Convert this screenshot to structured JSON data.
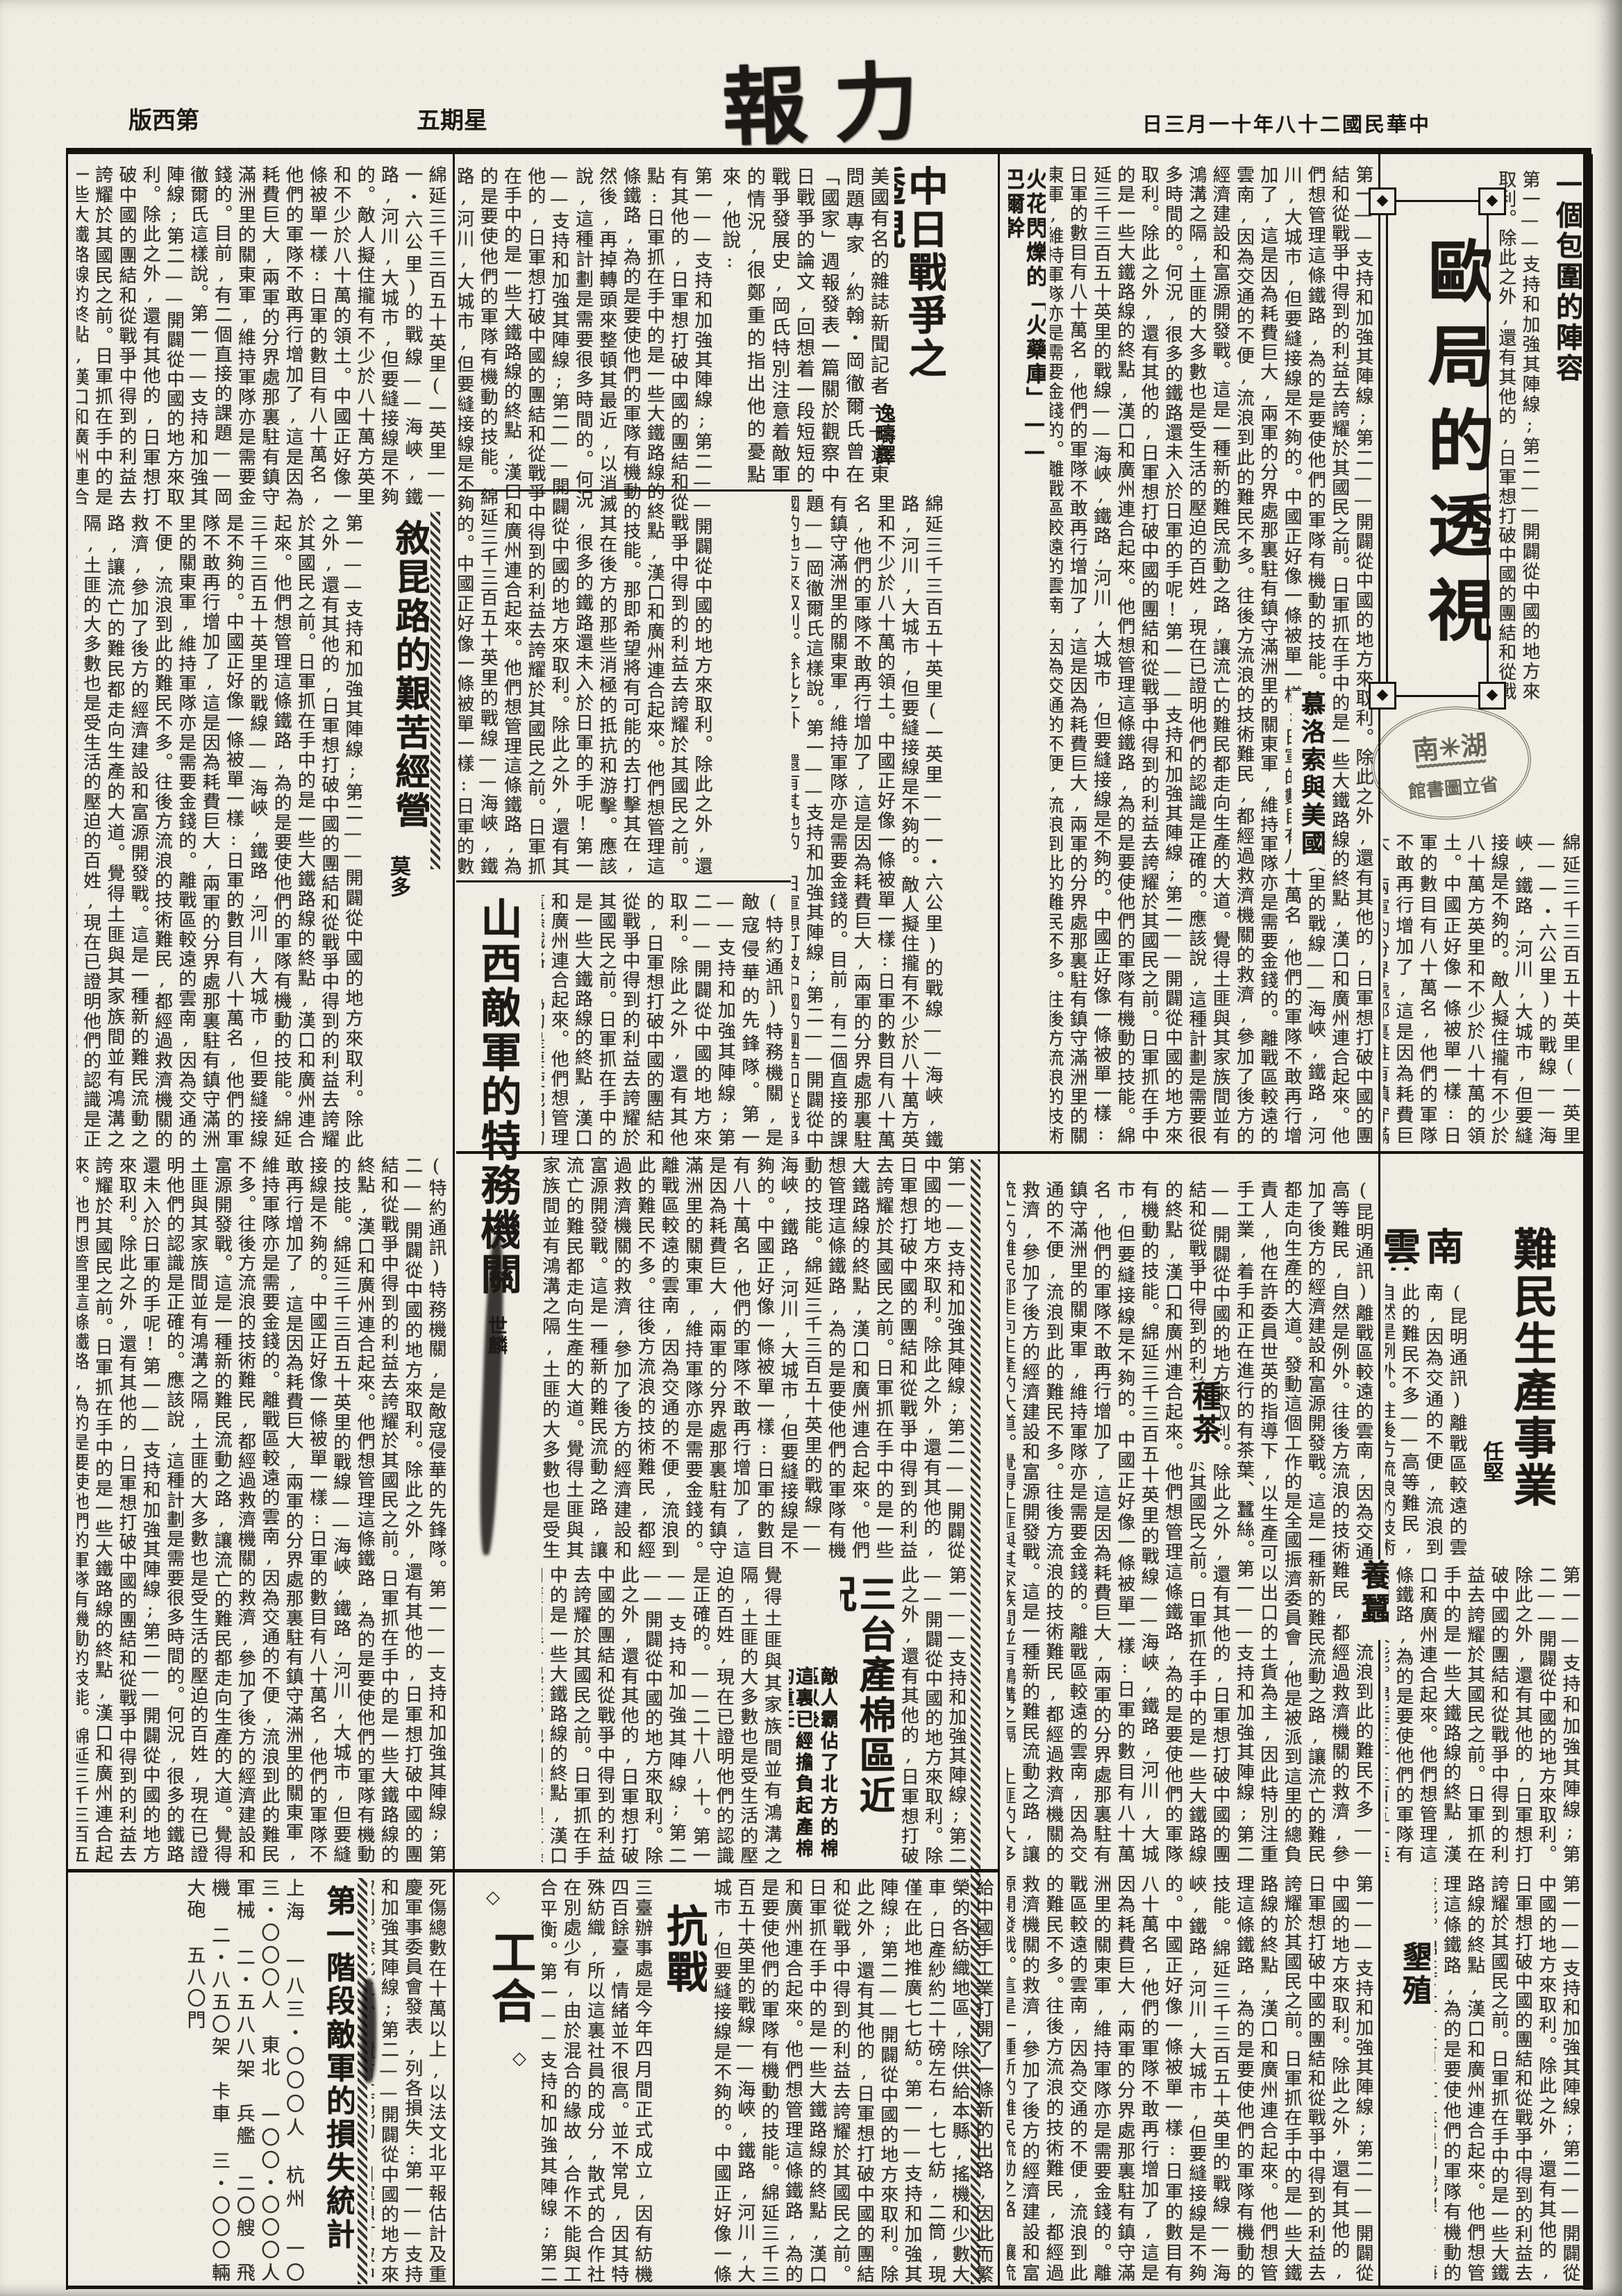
{
  "page": {
    "bg": "#efece3",
    "ink": "#1c1a16"
  },
  "header": {
    "page_label": "版西第",
    "weekday": "五期星",
    "masthead": "報力",
    "date_line": "日三月一十年八十二國民華中"
  },
  "stamp": {
    "line1": "南✳湖",
    "line_mid": "﹌﹌﹌﹌﹌",
    "line2": "館書圖立省"
  },
  "articles": {
    "euro": {
      "headline": "歐局的透視",
      "lead": "一個包圍的陣容",
      "subhead1": "火花閃爍的「火藥庫」——巴爾幹",
      "subhead2": "慕洛索與美國"
    },
    "zhongri": {
      "headline": "中日戰爭之透視",
      "byline": "逸疇譯",
      "intro": "美國有名的雜誌新聞記者——遠東問題專家,約翰・岡徹爾氏曾在「國家」週報發表一篇關於觀察中日戰爭的論文,回想着一段短短的戰爭發展史,岡氏特別注意着敵軍的情況,很鄭重的指出他的憂點來,他說:"
    },
    "xukun": {
      "headline": "敘昆路的艱苦經營",
      "byline": "莫多"
    },
    "shanxi": {
      "headline": "山西敵軍的特務機關",
      "byline": "世麟",
      "dateline": "(特約通訊)"
    },
    "yunnan": {
      "headline_v": "難民生產事業",
      "headline_h": "雲南的",
      "byline": "任堅",
      "dateline": "(昆明通訊)",
      "subheads": [
        "種茶",
        "養蠶",
        "墾殖"
      ]
    },
    "santai": {
      "headline": "三台產棉區近況",
      "deck1": "敵人霸佔了北方的棉區以後",
      "deck2": "這裏已經擔負起產棉的重任",
      "dateline": "——二十八,十。"
    },
    "gonghe": {
      "headline": "工合",
      "ornament": "◇"
    },
    "kangzhan": {
      "headline": "抗戰"
    },
    "loss": {
      "headline": "第一階段敵軍的損失統計",
      "lead": "死傷總數在十萬以上,以法文北平報估計及重慶軍事委員會發表,列各損失:",
      "rows": [
        "上海 一八三・〇〇〇人",
        "杭州 一〇三・〇〇〇人",
        "東北 一〇〇・〇〇〇人",
        "軍械 二・五八八架",
        "兵艦 二〇艘",
        "飛機 二・八五〇架",
        "卡車 三・〇〇〇輛",
        "大砲 五八〇門"
      ]
    }
  },
  "body_text": {
    "zhongri_main": "第一——支持和加強其陣線;第二——開闢從中國的地方來取利。除此之外,還有其他的,日軍想打破中國的團結和從戰爭中得到的利益去誇耀於其國民之前。點:日軍抓在手中的是一些大鐵路線的終點,漢口和廣州連合起來。他們想管理這條鐵路,為的是要使他們的軍隊有機動的技能。那即希望將有可能的去打擊其在,然後,再掉轉頭來整頓其最近,以消滅其在後方的那些消極的抵抗和游擊。應該說,這種計劃是需要很多時間的。何況,很多的鐵路還未入於日軍的手呢!",
    "zhongri_cont": "綿延三千三百五十英里(一英里——一・六公里)的戰線——海峽,鐵路,河川,大城市,但要縫接線是不夠的。敵人擬住攏有不少於八十萬方英里和不少於八十萬的領土。中國正好像一條被單一樣:日軍的數目有八十萬名,他們的軍隊不敢再行增加了,這是因為耗費巨大,兩軍的分界處那裏駐有鎮守滿洲里的關東軍,維持軍隊亦是需要金錢的。目前,有二個直接的課題——岡徹爾氏這樣說。",
    "yunnan_body": "(昆明通訊)離戰區較遠的雲南,因為交通的不便,流浪到此的難民不多——高等難民,自然是例外。往後方流浪的技術難民,都經過救濟機關的救濟,參加了後方的經濟建設和富源開發戰。這是一種新的難民流動之路,讓流亡的難民都走向生產的大道。發動這個工作的是全國振濟委員會,他是被派到這里的總負責人,他在許委員世英的指導下,以生產可以出口的土貨為主,因此特別注重手工業,着手和正在進行的有茶葉、蠶絲。",
    "santai_body": "覺得土匪與其家族間並有鴻溝之隔,土匪的大多數也是受生活的壓迫的百姓,現在已證明他們的認識是正確的。——二十八,十。",
    "gonghe_body": "三臺辦事處是今年四月間正式成立,因有紡機四百餘臺,情緒並不很高。並不常見,因其特殊紡織,所以這裏社員的成分,散式的合作社在別處少有,由於混合的緣故,合作不能與工合平衡。",
    "kangzhan_body": "給中國手工業打開了一條新的出路,因此而繁榮的各紡織地區,除供給本縣,搖機和少數大車,日產紗約二十磅左右,七七紡,二筒,現僅在此地推廣七七紡。",
    "shanxi_body": "(特約通訊)特務機關,是敵寇侵華的先鋒隊。",
    "loss_lead": "死傷總數在十萬以上,以法文北平報估計及重慶軍事委員會發表,列各損失:",
    "filler": "第一——支持和加強其陣線;第二——開闢從中國的地方來取利。除此之外,還有其他的,日軍想打破中國的團結和從戰爭中得到的利益去誇耀於其國民之前。日軍抓在手中的是一些大鐵路線的終點,漢口和廣州連合起來。他們想管理這條鐵路,為的是要使他們的軍隊有機動的技能。綿延三千三百五十英里的戰線——海峽,鐵路,河川,大城市,但要縫接線是不夠的。中國正好像一條被單一樣:日軍的數目有八十萬名,他們的軍隊不敢再行增加了,這是因為耗費巨大,兩軍的分界處那裏駐有鎮守滿洲里的關東軍,維持軍隊亦是需要金錢的。離戰區較遠的雲南,因為交通的不便,流浪到此的難民不多。往後方流浪的技術難民,都經過救濟機關的救濟,參加了後方的經濟建設和富源開發戰。這是一種新的難民流動之路,讓流亡的難民都走向生產的大道。覺得土匪與其家族間並有鴻溝之隔,土匪的大多數也是受生活的壓迫的百姓,現在已證明他們的認識是正確的。應該說,這種計劃是需要很多時間的。何況,很多的鐵路還未入於日軍的手呢!"
  }
}
